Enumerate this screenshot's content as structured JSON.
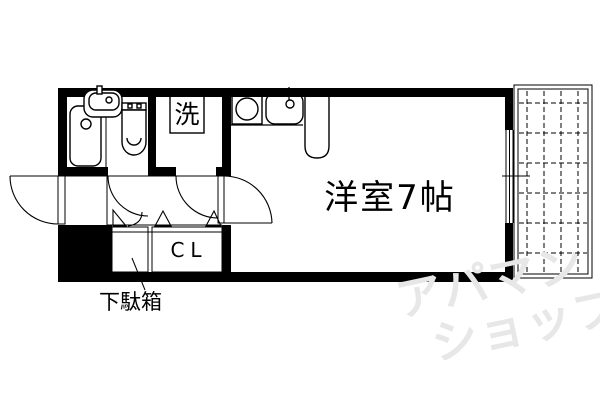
{
  "plan": {
    "room_label": "洋室7帖",
    "washer_label": "洗",
    "closet_label": "CL",
    "shoe_cabinet_label": "下駄箱"
  },
  "watermark": {
    "line1": "アパマン",
    "line2": "ショップ",
    "color": "#e7e7e7"
  },
  "colors": {
    "line": "#000000",
    "background": "#ffffff"
  }
}
